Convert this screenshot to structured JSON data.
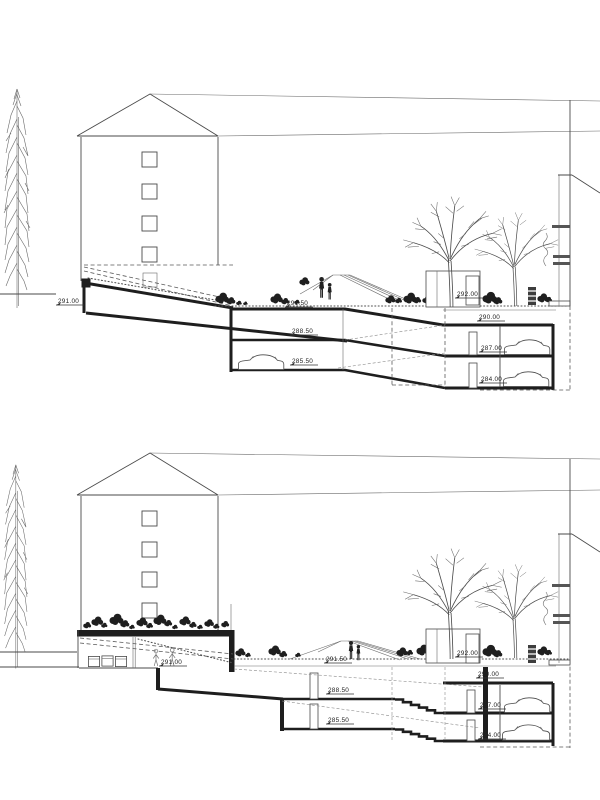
{
  "page": {
    "paper_color": "#ffffff",
    "ink_color": "#1e1e1e"
  },
  "sections": {
    "top": {
      "labels": {
        "street": "291.00",
        "courtyard": "291.50",
        "garage_mid_upper": "288.50",
        "garage_mid_lower": "285.50",
        "terrace": "292.00",
        "garage_right_upper": "290.00",
        "garage_right_middle": "287.00",
        "garage_right_lower": "284.00"
      }
    },
    "bottom": {
      "labels": {
        "entrance": "291.00",
        "courtyard": "291.50",
        "garage_mid_upper": "288.50",
        "garage_mid_lower": "285.50",
        "terrace": "292.00",
        "garage_right_upper": "290.00",
        "garage_right_middle": "287.00",
        "garage_right_lower": "284.00"
      }
    }
  }
}
